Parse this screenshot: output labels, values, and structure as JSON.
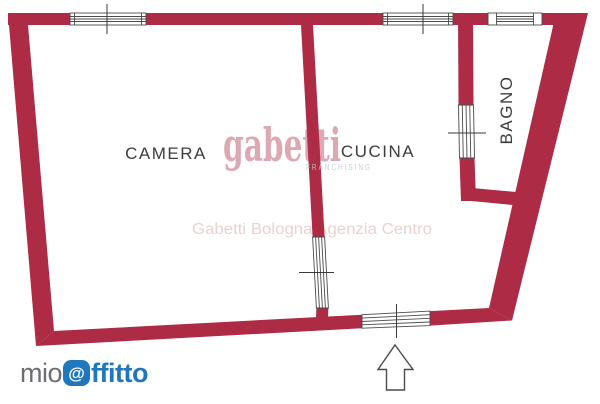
{
  "plan": {
    "rooms": [
      {
        "id": "camera",
        "label": "CAMERA"
      },
      {
        "id": "cucina",
        "label": "CUCINA"
      },
      {
        "id": "bagno",
        "label": "BAGNO"
      }
    ]
  },
  "watermarks": {
    "brand": "gabetti",
    "brand_sub": "FRANCHISING",
    "agency": "Gabetti Bologna Agenzia Centro"
  },
  "footer_logo": {
    "prefix": "mio",
    "at_symbol": "@",
    "suffix": "ffitto"
  },
  "icons": {
    "entrance_arrow": "up-arrow"
  },
  "colors": {
    "wall": "#ad2b45",
    "watermark_brand": "#b2314d",
    "watermark_agency": "#e8d2d2",
    "franchising_gray": "#c6c6c6",
    "room_label": "#3c3c3c",
    "logo_gray": "#6d6e71",
    "logo_blue": "#2077bc",
    "window_stroke": "#4a4a4a",
    "tick_stroke": "#3a3a3a"
  }
}
